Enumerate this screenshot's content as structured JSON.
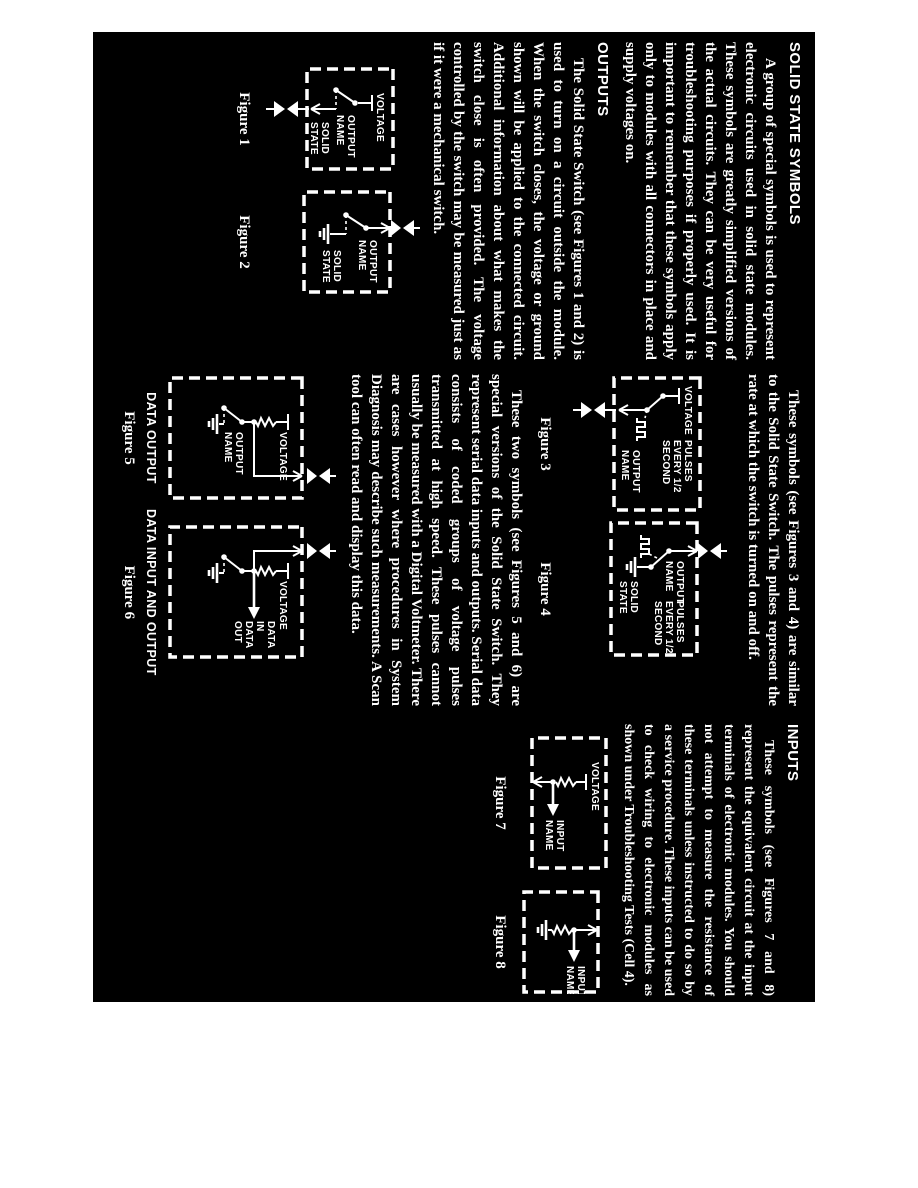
{
  "page": {
    "paper_color": "#ffffff",
    "scan_background": "#000000",
    "ink_color": "#ffffff"
  },
  "columns": {
    "col1": {
      "heading": "SOLID STATE SYMBOLS",
      "para1": "A group of special symbols is used to represent electronic circuits used in solid state modules. These symbols are greatly simplified versions of the actual circuits. They can be very useful for troubleshooting purposes if properly used. It is important to remember that these symbols apply only to modules with all connectors in place and supply voltages on.",
      "heading2": "OUTPUTS",
      "para2": "The Solid State Switch (see Figures 1 and 2) is used to turn on a circuit outside the module. When the switch closes, the voltage or ground shown will be applied to the connected circuit. Additional information about what makes the switch close is often provided. The voltage controlled by the switch may be measured just as if it were a mechanical switch."
    },
    "col2": {
      "para1": "These symbols (see Figures 3 and 4) are similar to the Solid State Switch. The pulses represent the rate at which the switch is turned on and off.",
      "para2": "These two symbols (see Figures 5 and 6) are special versions of the Solid State Switch. They represent serial data inputs and outputs. Serial data consists of coded groups of voltage pulses transmitted at high speed. These pulses cannot usually be measured with a Digital Voltmeter. There are cases however where procedures in System Diagnosis may describe such measurements. A Scan tool can often read and display this data."
    },
    "col3": {
      "heading": "INPUTS",
      "para1": "These symbols (see Figures 7 and 8) represent the equivalent circuit at the input terminals of electronic modules. You should not attempt to measure the resistance of these terminals unless instructed to do so by a service procedure. These inputs can be used to check wiring to electronic modules as shown under Troubleshooting Tests (Cell 4)."
    }
  },
  "figures": {
    "fig1": {
      "caption": "Figure 1",
      "voltage": "VOLTAGE",
      "output1": "OUTPUT",
      "output2": "NAME",
      "solid1": "SOLID",
      "solid2": "STATE"
    },
    "fig2": {
      "caption": "Figure 2",
      "output1": "OUTPUT",
      "output2": "NAME",
      "solid1": "SOLID",
      "solid2": "STATE"
    },
    "fig3": {
      "caption": "Figure 3",
      "voltage": "VOLTAGE",
      "pulses1": "PULSES",
      "pulses2": "EVERY 1/2",
      "pulses3": "SECOND",
      "output1": "OUTPUT",
      "output2": "NAME"
    },
    "fig4": {
      "caption": "Figure 4",
      "output1": "OUTPUT",
      "output2": "NAME",
      "pulses1": "PULSES",
      "pulses2": "EVERY 1/2",
      "pulses3": "SECOND",
      "solid1": "SOLID",
      "solid2": "STATE"
    },
    "fig5": {
      "title": "DATA OUTPUT",
      "caption": "Figure 5",
      "voltage": "VOLTAGE",
      "output1": "OUTPUT",
      "output2": "NAME"
    },
    "fig6": {
      "title": "DATA INPUT AND OUTPUT",
      "caption": "Figure 6",
      "voltage": "VOLTAGE",
      "data1": "DATA",
      "data2": "IN",
      "data3": "DATA",
      "data4": "OUT"
    },
    "fig7": {
      "caption": "Figure 7",
      "voltage": "VOLTAGE",
      "input1": "INPUT",
      "input2": "NAME"
    },
    "fig8": {
      "caption": "Figure 8",
      "input1": "INPUT",
      "input2": "NAME"
    }
  }
}
